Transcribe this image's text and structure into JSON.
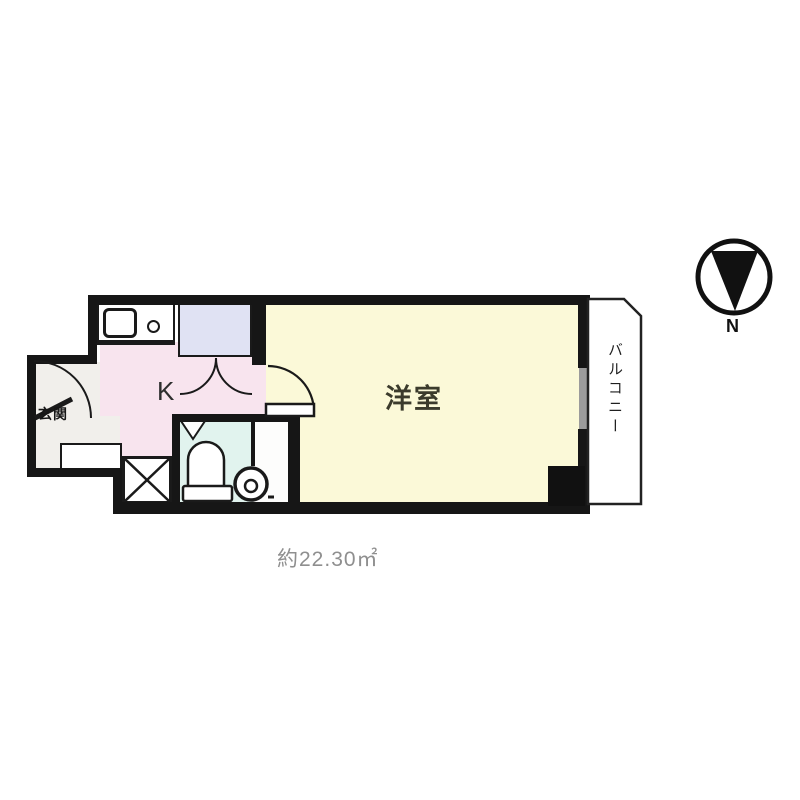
{
  "plan": {
    "labels": {
      "room": "洋室",
      "balcony": "バルコニー",
      "entrance": "玄関",
      "kitchen": "K",
      "north": "N",
      "area": "約22.30㎡"
    },
    "colors": {
      "wall": "#161616",
      "main_room_floor": "#fbf9d8",
      "kitchen_floor": "#f8e4ee",
      "closet_fill": "#e0e2f3",
      "bathroom_floor": "#e1f3ee",
      "entrance_floor": "#f1efeb",
      "window_sash": "#9b9b9b",
      "area_text": "#8f8f8f",
      "background": "#ffffff"
    },
    "fixtures": [
      "kitchen-sink",
      "stove-burner",
      "closet-double-doors",
      "entrance-door",
      "main-room-door",
      "shoe-cabinet",
      "washing-machine-space",
      "toilet",
      "washbasin",
      "bath-corner-shelf",
      "window",
      "pillar",
      "compass-north-down"
    ]
  }
}
